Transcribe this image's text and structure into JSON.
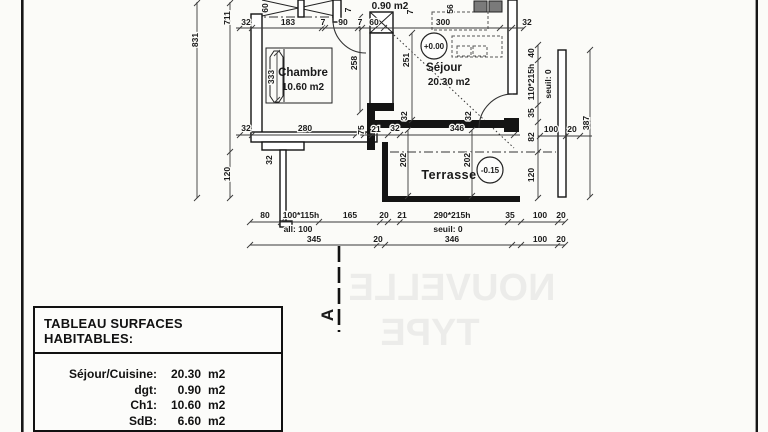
{
  "plan": {
    "rooms": {
      "chambre": {
        "name": "Chambre",
        "area": "10.60 m2"
      },
      "sejour": {
        "name": "Séjour",
        "area": "20.30 m2"
      },
      "terrasse": {
        "name": "Terrasse"
      },
      "dgt": {
        "area": "0.90 m2"
      }
    },
    "levels": {
      "ground": "+0.00",
      "terrace": "-0.15"
    },
    "section": {
      "label": "A"
    },
    "watermark": {
      "line1": "NOUVELLE",
      "line2": "TYPE"
    },
    "dims": {
      "top": [
        "32",
        "183",
        "7",
        "90",
        "7",
        "60",
        "300",
        "32"
      ],
      "left": [
        "831",
        "711",
        "120"
      ],
      "right_chain": [
        "40",
        "110*215h",
        "35",
        "seuil: 0",
        "82",
        "120"
      ],
      "right_outer": [
        "387"
      ],
      "right_width": [
        "100",
        "20"
      ],
      "chambre": [
        "333",
        "280",
        "32",
        "75",
        "21",
        "32",
        "60"
      ],
      "hall": [
        "258",
        "7",
        "7"
      ],
      "sejour": [
        "251",
        "56",
        "32",
        "346",
        "32",
        "32",
        "202",
        "202"
      ],
      "bottom_row1": [
        "80",
        "100*115h",
        "165",
        "20",
        "21",
        "290*215h",
        "35",
        "100",
        "20"
      ],
      "bottom_row2": [
        "all: 100",
        "seuil: 0"
      ],
      "bottom_row3": [
        "345",
        "20",
        "346",
        "100",
        "20"
      ]
    }
  },
  "table": {
    "title": "TABLEAU SURFACES HABITABLES:",
    "rows": [
      {
        "label": "Séjour/Cuisine:",
        "value": "20.30",
        "unit": "m2"
      },
      {
        "label": "dgt:",
        "value": "0.90",
        "unit": "m2"
      },
      {
        "label": "Ch1:",
        "value": "10.60",
        "unit": "m2"
      },
      {
        "label": "SdB:",
        "value": "6.60",
        "unit": "m2"
      }
    ]
  }
}
